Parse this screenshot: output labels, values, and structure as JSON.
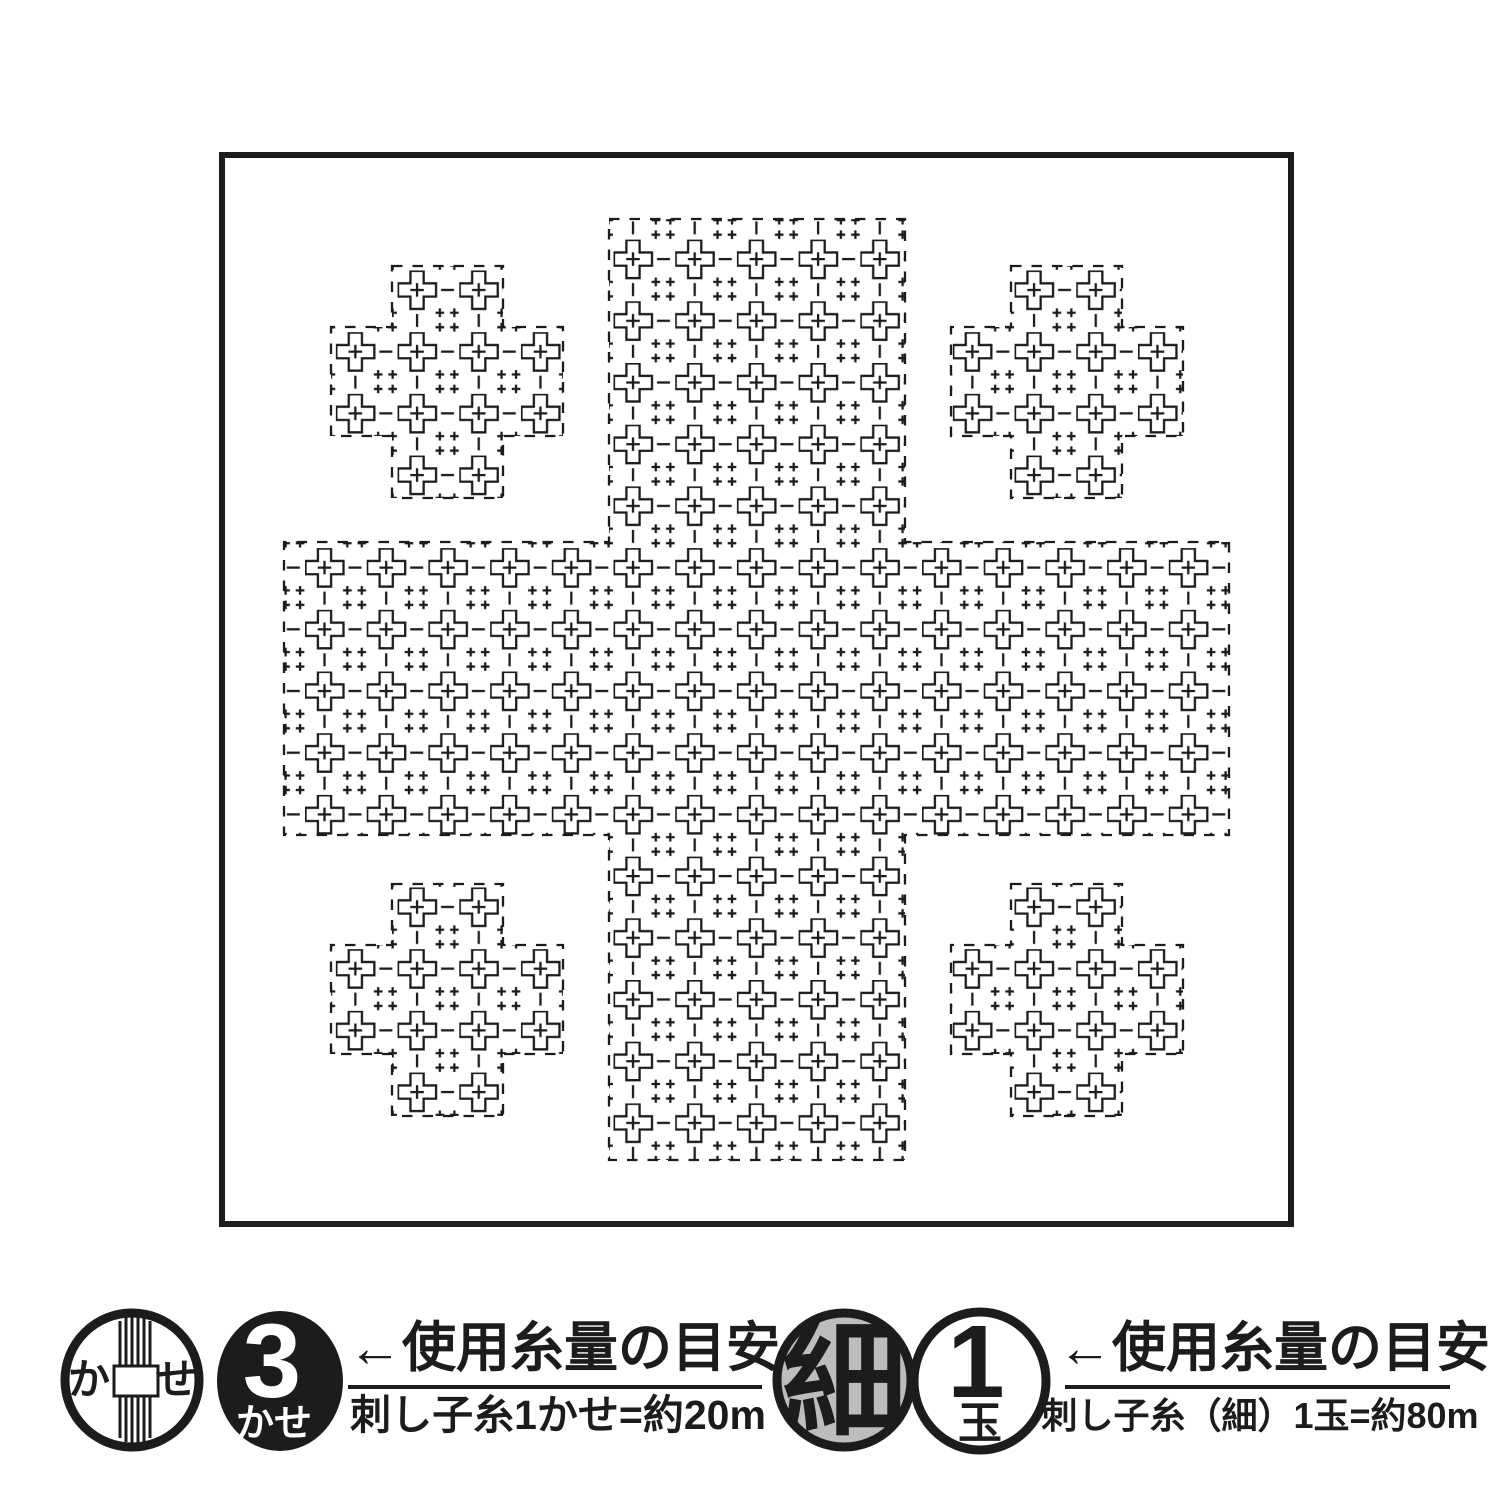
{
  "colors": {
    "ink": "#1c1c1c",
    "paper": "#ffffff",
    "stamp_gray": "#bdbdbd"
  },
  "legend": {
    "skein_group": {
      "icon": "thread-skein-icon",
      "icon_char_left": "か",
      "icon_char_right": "せ",
      "badge_value": "3",
      "badge_unit": "かせ",
      "usage_label": "←使用糸量の目安",
      "usage_note": "刺し子糸1かせ=約20m"
    },
    "thin_thread_group": {
      "icon": "hoso-stamp-icon",
      "stamp_char": "細",
      "badge_value": "1",
      "badge_unit": "玉",
      "usage_label": "←使用糸量の目安",
      "usage_note": "刺し子糸（細）1玉=約80m"
    }
  }
}
